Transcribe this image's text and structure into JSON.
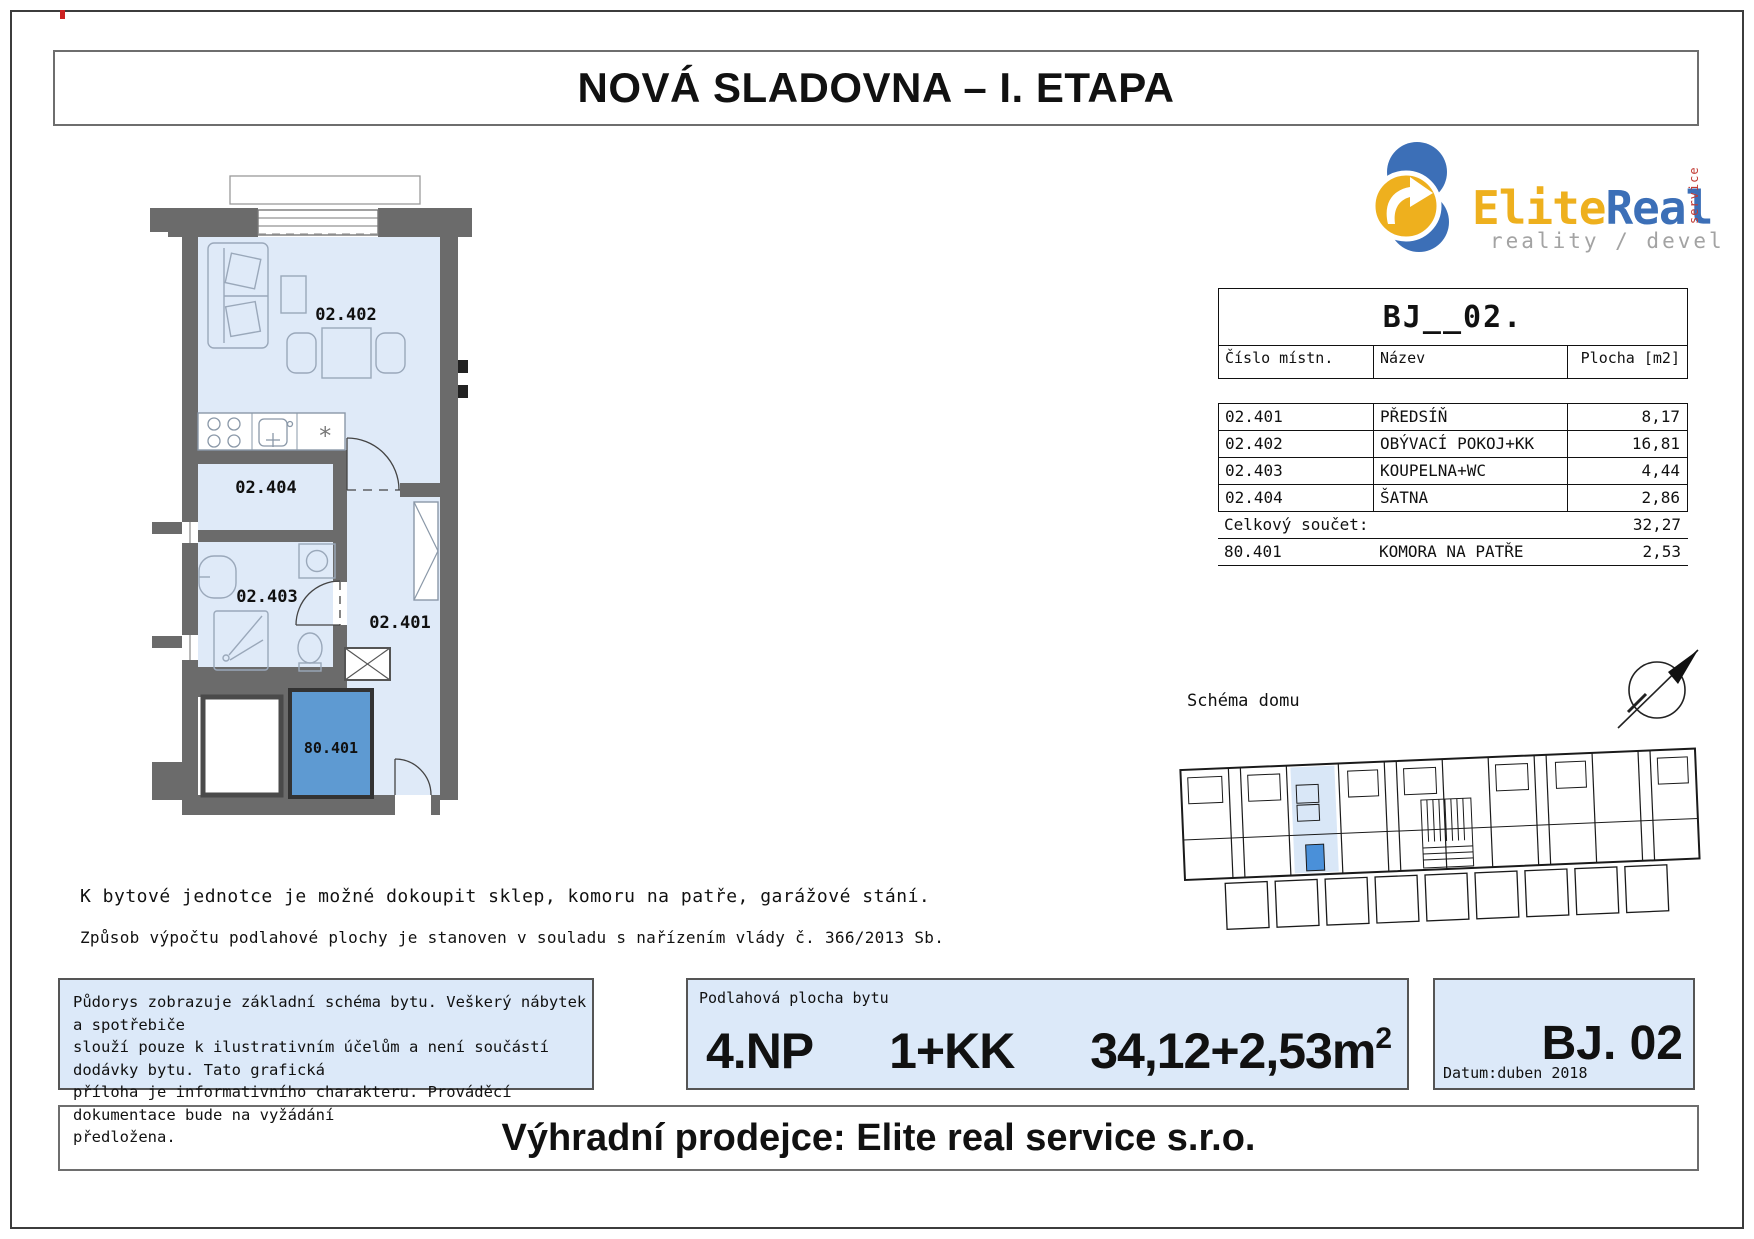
{
  "page": {
    "title": "NOVÁ SLADOVNA – I. ETAPA",
    "footer_banner": "Výhradní prodejce: Elite real service s.r.o."
  },
  "logo": {
    "brand_primary": "Elite",
    "brand_secondary": "Real",
    "brand_service": "service",
    "tagline": "reality / developer",
    "colors": {
      "yellow": "#eeb01e",
      "blue": "#3c6fb7",
      "red": "#c23b34",
      "gray": "#a3a3a3"
    }
  },
  "unit_table": {
    "title": "BJ__02.",
    "columns": {
      "number": "Číslo místn.",
      "name": "Název",
      "area": "Plocha [m2]"
    },
    "rows": [
      {
        "number": "02.401",
        "name": "PŘEDSÍŇ",
        "area": "8,17"
      },
      {
        "number": "02.402",
        "name": "OBÝVACÍ POKOJ+KK",
        "area": "16,81"
      },
      {
        "number": "02.403",
        "name": "KOUPELNA+WC",
        "area": "4,44"
      },
      {
        "number": "02.404",
        "name": "ŠATNA",
        "area": "2,86"
      }
    ],
    "total": {
      "label": "Celkový součet:",
      "value": "32,27"
    },
    "extra_row": {
      "number": "80.401",
      "name": "KOMORA NA PATŘE",
      "area": "2,53"
    }
  },
  "floor_plan": {
    "rooms": [
      {
        "id": "02.402"
      },
      {
        "id": "02.404"
      },
      {
        "id": "02.403"
      },
      {
        "id": "02.401"
      },
      {
        "id": "80.401"
      }
    ],
    "colors": {
      "wall": "#6b6b6b",
      "room_fill": "#dfeaf8",
      "storage_highlight": "#5e9ad2"
    }
  },
  "schema": {
    "label": "Schéma domu",
    "highlight_fill": "#d9e7f7",
    "highlight_unit": "#4a90d9"
  },
  "notes": {
    "line1": "K bytové jednotce je možné dokoupit sklep, komoru na patře, garážové stání.",
    "line2": "Způsob výpočtu podlahové plochy je stanoven v souladu s nařízením vlády č. 366/2013 Sb."
  },
  "disclaimer": {
    "lines": [
      "Půdorys zobrazuje základní schéma bytu. Veškerý nábytek a spotřebiče",
      "slouží pouze k ilustrativním účelům a není součástí dodávky bytu. Tato grafická",
      "příloha je informativního charakteru. Prováděcí dokumentace bude na vyžádání",
      "předložena."
    ]
  },
  "summary": {
    "label": "Podlahová plocha bytu",
    "floor": "4.NP",
    "layout": "1+KK",
    "area": "34,12+2,53m",
    "area_sup": "2"
  },
  "unit_badge": {
    "id": "BJ. 02",
    "date_label": "Datum:",
    "date_value": "duben 2018"
  }
}
